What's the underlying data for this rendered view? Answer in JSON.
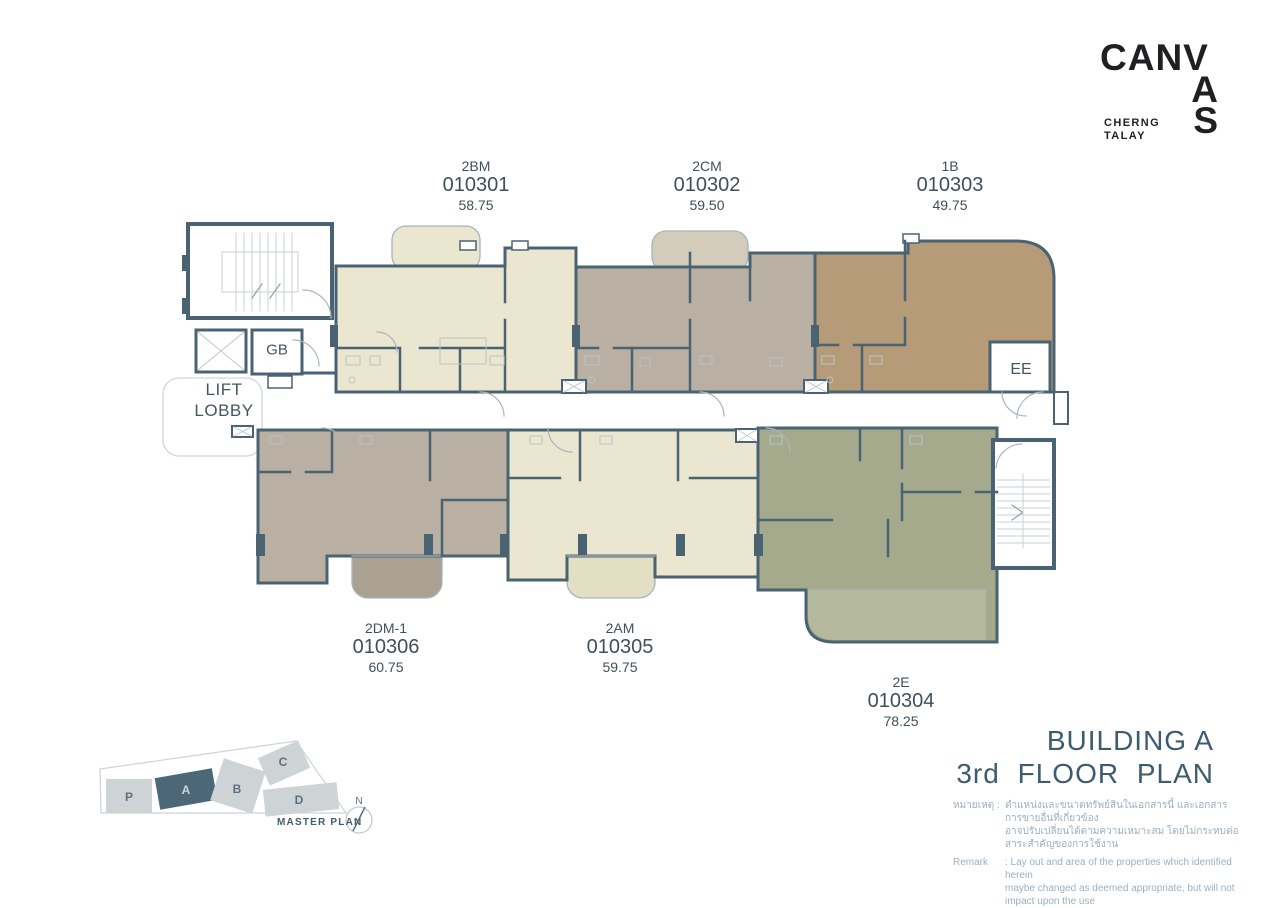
{
  "brand": {
    "logo_row1": "CANV",
    "logo_row2": "A",
    "logo_row3": "S",
    "tagline1": "CHERNG",
    "tagline2": "TALAY"
  },
  "page": {
    "title_line1": "BUILDING A",
    "title_line2": "3rd FLOOR PLAN"
  },
  "units": [
    {
      "id": "2bm",
      "type": "2BM",
      "number": "010301",
      "area": "58.75",
      "color": "#eae6cf"
    },
    {
      "id": "2cm",
      "type": "2CM",
      "number": "010302",
      "area": "59.50",
      "color": "#b9b0a3"
    },
    {
      "id": "1b",
      "type": "1B",
      "number": "010303",
      "area": "49.75",
      "color": "#b59b77"
    },
    {
      "id": "2e",
      "type": "2E",
      "number": "010304",
      "area": "78.25",
      "color": "#a5aa8c"
    },
    {
      "id": "2am",
      "type": "2AM",
      "number": "010305",
      "area": "59.75",
      "color": "#eae6cf"
    },
    {
      "id": "2dm1",
      "type": "2DM-1",
      "number": "010306",
      "area": "60.75",
      "color": "#b9b0a3"
    }
  ],
  "rooms": {
    "lift_lobby": "LIFT LOBBY",
    "gb": "GB",
    "ee": "EE"
  },
  "master_plan": {
    "label": "MASTER PLAN",
    "north": "N",
    "highlighted": "A",
    "buildings": [
      {
        "label": "P"
      },
      {
        "label": "A"
      },
      {
        "label": "B"
      },
      {
        "label": "C"
      },
      {
        "label": "D"
      }
    ]
  },
  "remark": {
    "thai_label": "หมายเหตุ :",
    "thai_line1": "ตำแหน่งและขนาดทรัพย์สินในเอกสารนี้ และเอกสารการขายอื่นที่เกี่ยวข้อง",
    "thai_line2": "อาจปรับเปลี่ยนได้ตามความเหมาะสม โดยไม่กระทบต่อสาระสำคัญของการใช้งาน",
    "en_label": "Remark",
    "en_line1": ": Lay out and area of the properties which identified herein",
    "en_line2": "maybe changed as deemed appropriate, but will not impact upon the use"
  },
  "colors": {
    "wall": "#4a6372",
    "cream": "#eae6cf",
    "taupe": "#b9b0a3",
    "tan": "#b59b77",
    "green": "#a5aa8c",
    "balcony_taupe": "#aba191",
    "balcony_cream": "#e3dfc5",
    "balcony_green": "#b4b89d",
    "master_highlight": "#4c6878",
    "master_gray": "#ced3d6",
    "text_dark": "#3f505b",
    "title": "#3d5c6e",
    "remark_text": "#9cb0be"
  }
}
